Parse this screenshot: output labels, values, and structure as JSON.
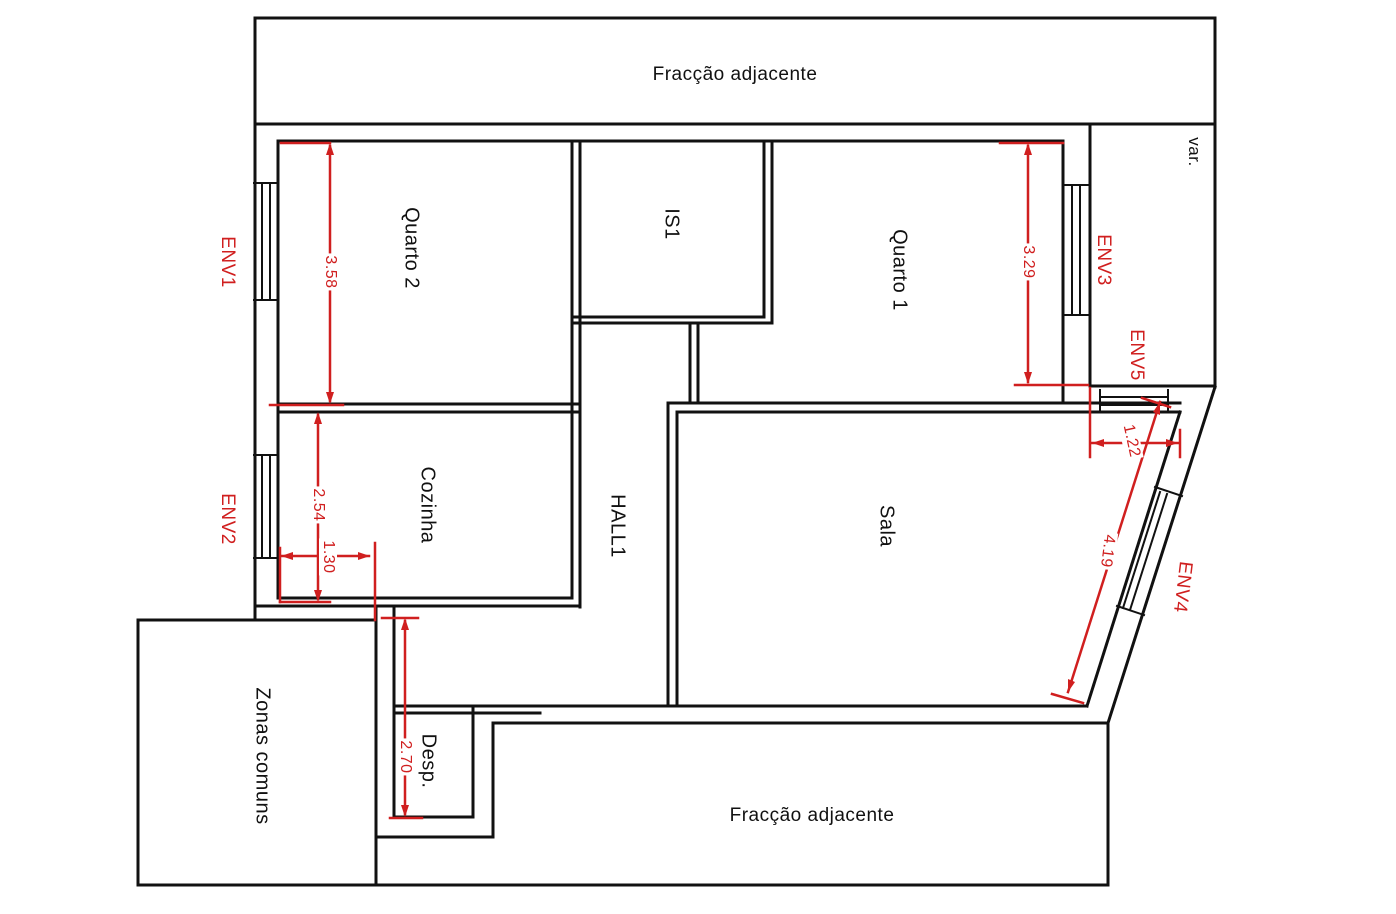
{
  "canvas": {
    "width": 1396,
    "height": 914,
    "background": "#ffffff"
  },
  "colors": {
    "wall": "#111111",
    "dimension": "#d01f1f",
    "room_label": "#111111"
  },
  "labels": {
    "fraccao_top": "Fracção adjacente",
    "fraccao_bottom": "Fracção adjacente",
    "quarto2": "Quarto 2",
    "is1": "IS1",
    "quarto1": "Quarto 1",
    "var": "var.",
    "cozinha": "Cozinha",
    "hall1": "HALL1",
    "sala": "Sala",
    "zonas_comuns": "Zonas comuns",
    "desp": "Desp.",
    "env1": "ENV1",
    "env2": "ENV2",
    "env3": "ENV3",
    "env4": "ENV4",
    "env5": "ENV5"
  },
  "dimensions": {
    "quarto2_height_m": "3.58",
    "cozinha_height_m": "2.54",
    "cozinha_width_m": "1.30",
    "desp_height_m": "2.70",
    "quarto1_height_m": "3.29",
    "sala_top_width_m": "1.22",
    "sala_diagonal_m": "4.19"
  }
}
